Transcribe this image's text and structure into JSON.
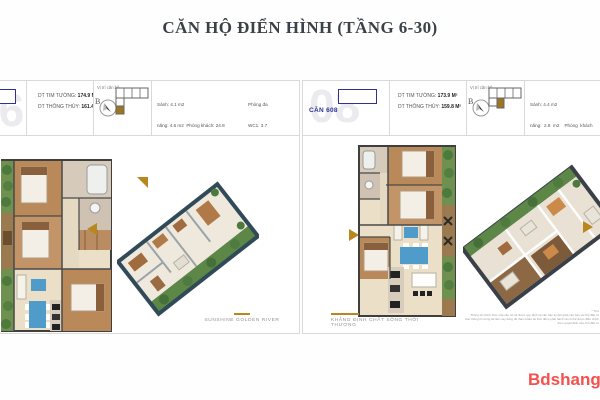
{
  "page": {
    "title": "CĂN HỘ ĐIỂN HÌNH (TẦNG 6-30)",
    "brand_watermark": "Bdshanghi",
    "colors": {
      "gold": "#b8871e",
      "navy": "#2e3192",
      "red": "#f4514e",
      "wall": "#3f3f3f",
      "wood": "#b9895a",
      "beige": "#ecdfc8",
      "blue": "#4f9bc9",
      "green": "#6e9150",
      "teal_3d": "#304a58",
      "border": "#d9d9d9",
      "watermark_gray": "#eaeaef"
    },
    "icons": {
      "compass": "needle-circle",
      "unit_arrow": "triangle",
      "plan_flag": "corner-triangle"
    }
  },
  "left_panel": {
    "unit_watermark": "06",
    "metrics": [
      {
        "label": "DT TIM TƯỜNG: ",
        "value": "174.9 M²"
      },
      {
        "label": "DT THÔNG THỦY: ",
        "value": "161.4 M²"
      }
    ],
    "location_label": "Vị trí căn hộ",
    "compass_letter": "B",
    "rooms_col1": [
      "Sảnh: 4.1 m2",
      "năng: 4.6 m2  Phòng khách: 24.8",
      "m2",
      "Bếp + Ăn: 26.0 m2",
      "Phòng ngủ 1: 19.1 m2",
      "Phòng ngủ 2: 14.8 m2",
      "Phòng ngủ 3: 13.2 m2"
    ],
    "rooms_col2": [
      "Phòng đa",
      "WC1: 3.7",
      "",
      "WC2: 7.4 m2",
      "Logia1: 31.2 m2",
      "Logia2: 3.1 m2"
    ],
    "caption": "SUNSHINE GOLDEN RIVER"
  },
  "right_panel": {
    "unit_watermark": "08",
    "unit_label": "CĂN 608",
    "metrics": [
      {
        "label": "DT TIM TƯỜNG: ",
        "value": "173.9 M²"
      },
      {
        "label": "DT THÔNG THỦY: ",
        "value": "159.8 M²"
      }
    ],
    "location_label": "Vị trí căn hộ",
    "compass_letter": "B",
    "rooms_col1": [
      "Sảnh: 4.4 m2",
      "năng:  2.8  m2    Phòng  khách",
      "h  lang:  2.9  m2     Bếp  +  Ă",
      "1: 4.5 m2",
      "Phòng ngủ 1: 23.3 m2",
      "Phòng ngủ 2: 13.7 m2",
      "Phòng ngủ 3: 13.2 m2"
    ],
    "caption_line1": "KHẲNG ĐỊNH CHẤT SỐNG THỜI",
    "caption_line2": "THƯỢNG",
    "disclaimer": [
      "* Thư",
      "Thông số chính thức của căn hộ sẽ được quy định tại văn bản ký kết giữa các bên và chủ đầu tư",
      "Các thông tin trong tài liệu này dùng để tham khảo tại thời điểm phát hành và có thể được điều chỉnh",
      "theo quyết định của chủ đầu tư"
    ]
  }
}
